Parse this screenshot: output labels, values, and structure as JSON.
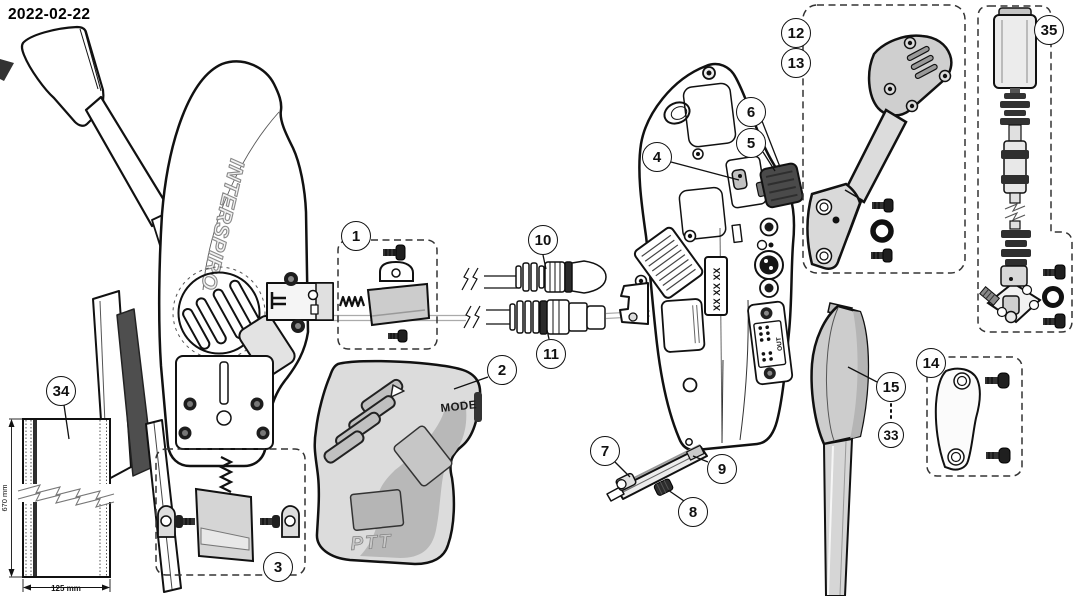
{
  "page": {
    "date_label": "2022-02-22"
  },
  "figure": {
    "brand_vertical_text": "INTERSPIRO",
    "cover_mode_label": "MODE",
    "cover_ptt_label": "PTT",
    "serial_placeholder_label": "XX XX XX",
    "connector_out_label": "OUT",
    "strap_length_dimension": "670 mm",
    "strap_width_dimension": "125 mm"
  },
  "callouts": [
    {
      "num": "1"
    },
    {
      "num": "2"
    },
    {
      "num": "3"
    },
    {
      "num": "4"
    },
    {
      "num": "5"
    },
    {
      "num": "6"
    },
    {
      "num": "7"
    },
    {
      "num": "8"
    },
    {
      "num": "9"
    },
    {
      "num": "10"
    },
    {
      "num": "11"
    },
    {
      "num": "12"
    },
    {
      "num": "13"
    },
    {
      "num": "14"
    },
    {
      "num": "15"
    },
    {
      "num": "33"
    },
    {
      "num": "34"
    },
    {
      "num": "35"
    }
  ],
  "colors": {
    "background": "#ffffff",
    "line": "#111111",
    "part_grey_light": "#dcdcdc",
    "part_grey_mid": "#c0c0c0",
    "part_grey_dark": "#4a4a4a"
  }
}
